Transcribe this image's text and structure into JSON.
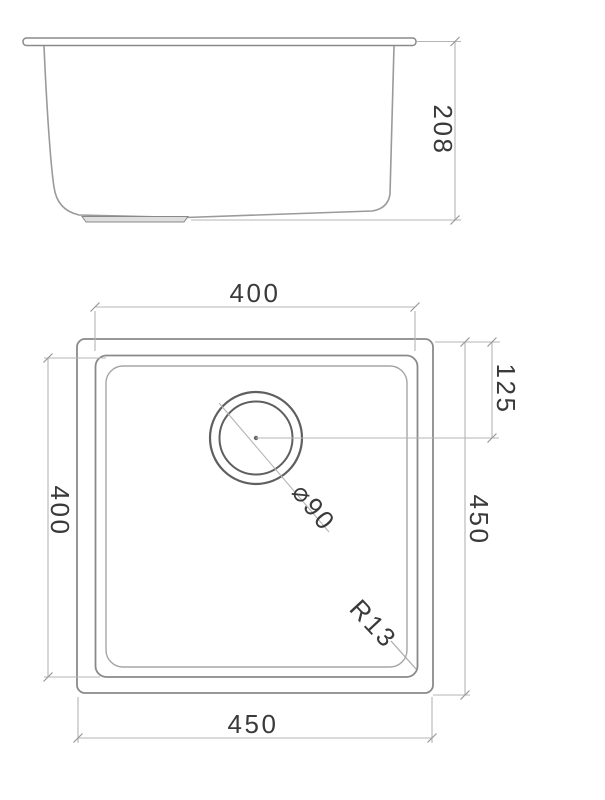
{
  "drawing_type": "sink-technical-drawing",
  "colors": {
    "background": "#ffffff",
    "object_line": "#8a8a8a",
    "drain_line": "#5f5f5f",
    "dimension_line": "#b5b5b5",
    "text": "#3a3a3a"
  },
  "side_view": {
    "depth_label": "208"
  },
  "plan_view": {
    "top_width_label": "400",
    "left_height_label": "400",
    "drain_offset_label": "125",
    "right_height_label": "450",
    "bottom_width_label": "450",
    "drain_diameter_label": "⌀90",
    "corner_radius_label": "R13"
  }
}
